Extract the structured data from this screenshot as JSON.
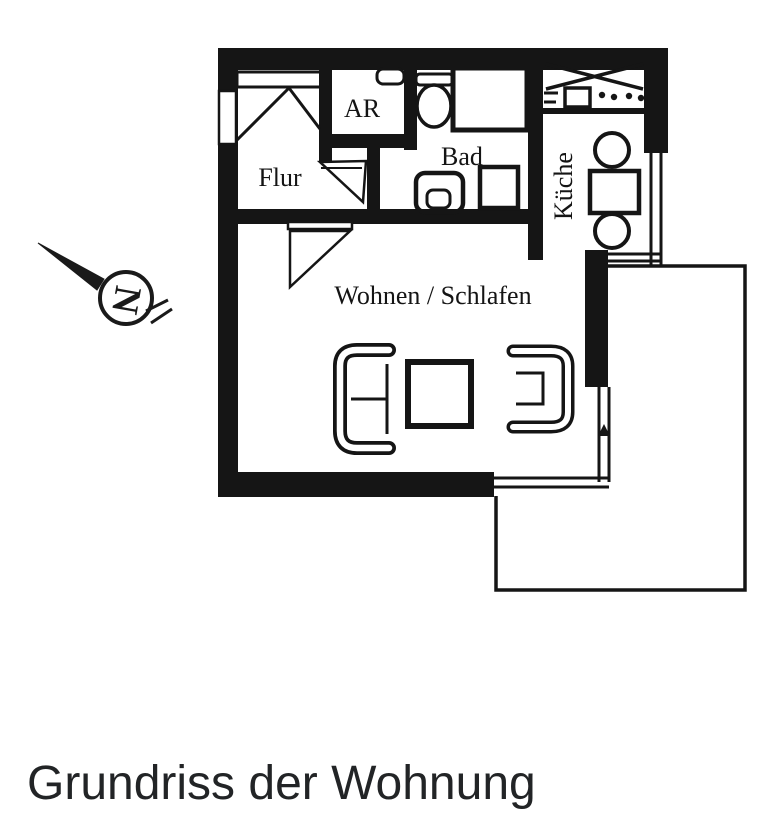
{
  "caption": {
    "text": "Grundriss der Wohnung"
  },
  "colors": {
    "ink": "#151515",
    "caption_text": "#222426",
    "background": "#ffffff"
  },
  "floorplan": {
    "rooms": {
      "flur": {
        "label": "Flur"
      },
      "abstellraum": {
        "label": "AR"
      },
      "bad": {
        "label": "Bad"
      },
      "kueche": {
        "label": "Küche"
      },
      "wohnen_schlafen": {
        "label": "Wohnen / Schlafen"
      }
    },
    "compass": {
      "north_label": "N"
    }
  }
}
